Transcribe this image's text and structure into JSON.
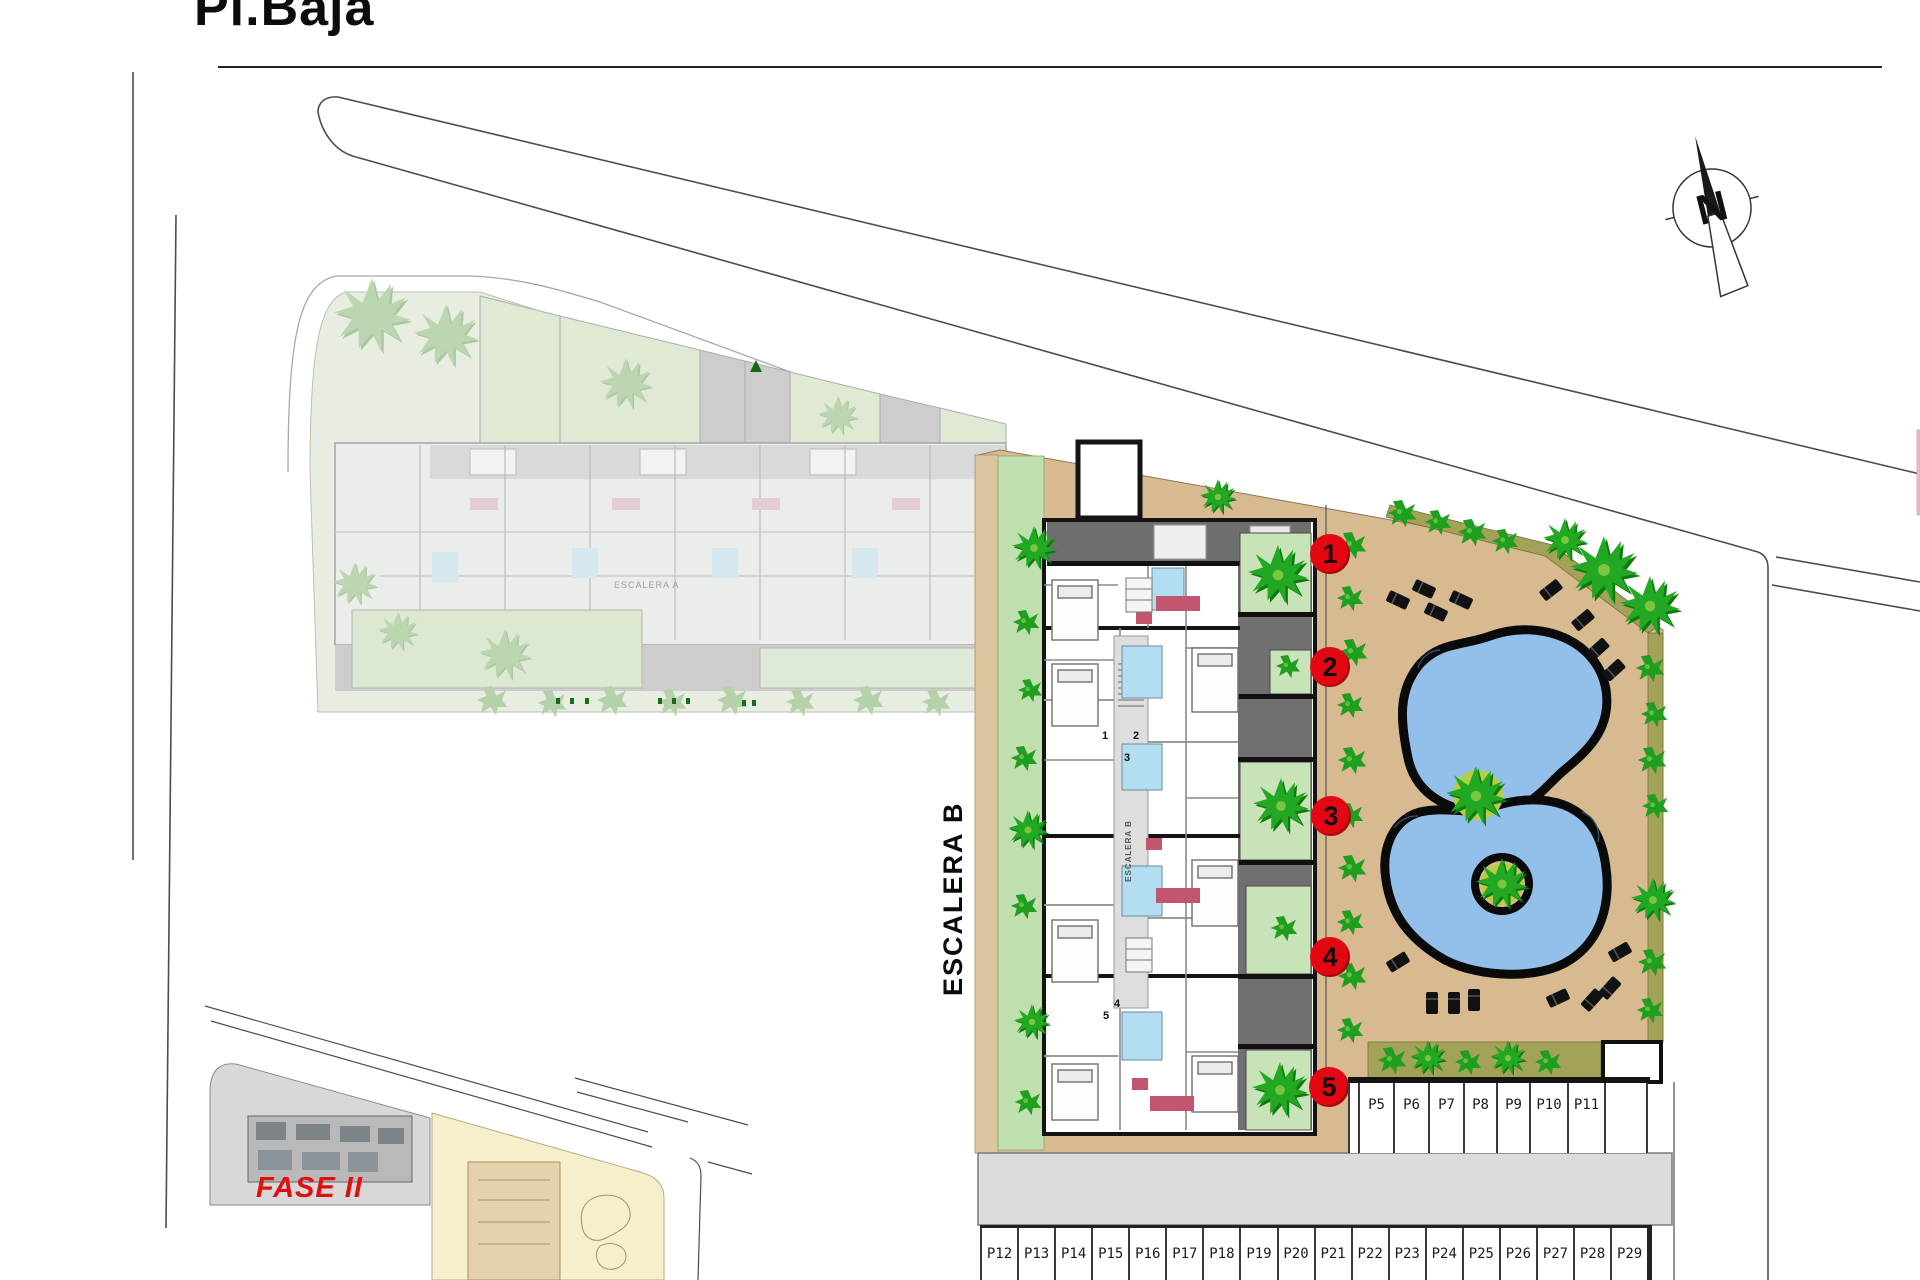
{
  "page": {
    "title": "Pl.Baja"
  },
  "plan": {
    "stair_b_label": "ESCALERA B",
    "stair_b_small_label": "ESCALERA B",
    "stair_a_small_label": "ESCALERA A",
    "phase_label": "FASE II",
    "compass_label": "N",
    "unit_markers": [
      "1",
      "2",
      "3",
      "4",
      "5"
    ],
    "unit_plan_numbers": [
      "1",
      "2",
      "3",
      "4",
      "5"
    ],
    "parking_upper": [
      "P5",
      "P6",
      "P7",
      "P8",
      "P9",
      "P10",
      "P11"
    ],
    "parking_lower": [
      "P12",
      "P13",
      "P14",
      "P15",
      "P16",
      "P17",
      "P18",
      "P19",
      "P20",
      "P21",
      "P22",
      "P23",
      "P24",
      "P25",
      "P26",
      "P27",
      "P28",
      "P29"
    ],
    "colors": {
      "marker_red": "#e30613",
      "phase_red": "#e01010",
      "pool_blue": "#92c0ea",
      "deck_tan": "#d7ba90",
      "lawn_green": "#bfdfae",
      "patio_green": "#c9e3b8",
      "road_gray": "#dcdcdc",
      "tree_green": "#22a822"
    }
  }
}
